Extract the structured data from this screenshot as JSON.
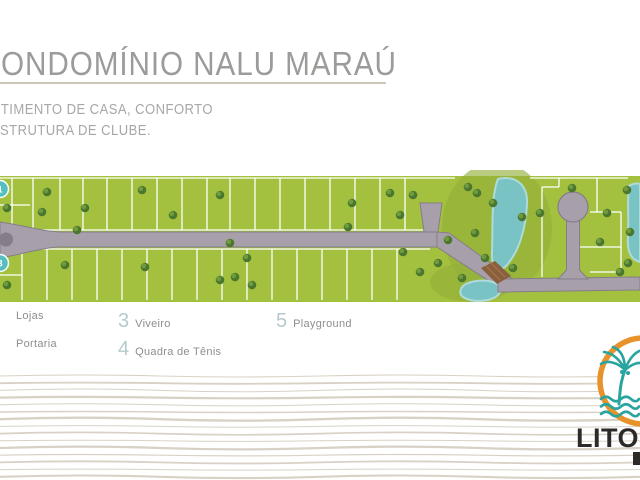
{
  "header": {
    "title": "ONDOMÍNIO NALU MARAÚ",
    "subtitle_line1": "NTIMENTO DE CASA, CONFORTO",
    "subtitle_line2": "STRUTURA DE CLUBE.",
    "title_color": "#9b9b99",
    "subtitle_color": "#a7a7a5",
    "rule_color": "#cdc6ba"
  },
  "legend": {
    "number_color": "#b4cacc",
    "label_color": "#8e8e8c",
    "items": [
      {
        "number": "",
        "label": "Lojas"
      },
      {
        "number": "",
        "label": "Portaria"
      },
      {
        "number": "3",
        "label": "Viveiro"
      },
      {
        "number": "4",
        "label": "Quadra de Tênis"
      },
      {
        "number": "5",
        "label": "Playground"
      }
    ]
  },
  "map": {
    "colors": {
      "grass": "#a3c13e",
      "grass_dark": "#94b13a",
      "road": "#a7a0ab",
      "road_edge": "#857d8a",
      "lot_line": "#ffffff",
      "water": "#7ac3c5",
      "water_edge": "#aedbd9",
      "tree_dark": "#4a762f",
      "tree_light": "#74a03e",
      "bridge": "#8a5f3e",
      "bridge_light": "#a5764d",
      "marker": "#54bec0",
      "marker_text": "#ffffff"
    },
    "grass": {
      "y": 6,
      "h": 126
    },
    "dark_patches": [
      [
        497,
        58,
        55,
        66
      ],
      [
        472,
        112,
        42,
        20
      ]
    ],
    "lot_lines": {
      "upper_xs": [
        12,
        33,
        60,
        83,
        107,
        132,
        157,
        182,
        207,
        230,
        255,
        280,
        305,
        330,
        355,
        380,
        405
      ],
      "upper_y": [
        8,
        60
      ],
      "lower_xs": [
        22,
        47,
        72,
        97,
        122,
        147,
        172,
        197,
        222,
        247,
        272,
        297,
        322,
        347,
        372,
        397
      ],
      "lower_y": [
        79,
        130
      ],
      "segments": [
        [
          0,
          8,
          455,
          8
        ],
        [
          530,
          8,
          628,
          8
        ],
        [
          0,
          60,
          437,
          60
        ],
        [
          0,
          79,
          430,
          79
        ],
        [
          0,
          35,
          30,
          35
        ],
        [
          0,
          105,
          22,
          105
        ],
        [
          542,
          17,
          542,
          107
        ],
        [
          542,
          17,
          559,
          17
        ],
        [
          559,
          8,
          559,
          17
        ],
        [
          597,
          8,
          597,
          42
        ],
        [
          590,
          42,
          621,
          42
        ],
        [
          621,
          42,
          621,
          102
        ],
        [
          580,
          77,
          621,
          77
        ],
        [
          590,
          102,
          621,
          102
        ]
      ]
    },
    "roads_a": [
      "M0,52 C28,56 44,62 62,62 L437,62 L437,77 L62,77 C44,77 28,83 0,88 Z",
      "M420,33 L442,33 L438,62 L424,62 Z",
      "M437,62 L449,63 L511,108 L498,117 L437,77 Z"
    ],
    "roads_b": [
      "M498,109 L640,107 L640,120 L498,122 Z",
      "M566.5,38 L579.5,38 L579.5,100 L588,109 L558,109 L566.5,100 Z"
    ],
    "culdesac": {
      "cx": 573,
      "cy": 37,
      "r": 15
    },
    "roundabout": {
      "cx": 6,
      "cy": 69.5,
      "r": 7
    },
    "water": [
      "M498,9 C515,5 528,14 527,34 C526,58 519,82 506,96 C499,103 491,98 492,82 C493,56 491,26 498,9 Z",
      "M461,119 C464,110 492,107 499,116 C504,124 494,131 477,131 C465,130 458,126 461,119 Z",
      "M629,16 C635,12 640,14 640,14 L640,92 C632,90 627,83 628,68 C629,48 627,32 629,16 Z"
    ],
    "bridge": {
      "d": "M481,98 L495,91 L511,106 L497,114 Z",
      "stripes": [
        "M486,96 L500,110",
        "M491,93 L505,107"
      ]
    },
    "trees": [
      [
        47,
        22
      ],
      [
        42,
        42
      ],
      [
        85,
        38
      ],
      [
        142,
        20
      ],
      [
        173,
        45
      ],
      [
        220,
        25
      ],
      [
        77,
        60
      ],
      [
        230,
        73
      ],
      [
        65,
        95
      ],
      [
        145,
        97
      ],
      [
        247,
        88
      ],
      [
        235,
        107
      ],
      [
        220,
        110
      ],
      [
        252,
        115
      ],
      [
        352,
        33
      ],
      [
        390,
        23
      ],
      [
        400,
        45
      ],
      [
        348,
        57
      ],
      [
        413,
        25
      ],
      [
        403,
        82
      ],
      [
        420,
        102
      ],
      [
        438,
        93
      ],
      [
        448,
        70
      ],
      [
        468,
        17
      ],
      [
        477,
        23
      ],
      [
        493,
        33
      ],
      [
        475,
        63
      ],
      [
        462,
        108
      ],
      [
        485,
        88
      ],
      [
        522,
        47
      ],
      [
        513,
        98
      ],
      [
        540,
        43
      ],
      [
        572,
        18
      ],
      [
        600,
        72
      ],
      [
        627,
        20
      ],
      [
        607,
        43
      ],
      [
        630,
        62
      ],
      [
        628,
        93
      ],
      [
        620,
        102
      ],
      [
        7,
        38
      ],
      [
        7,
        115
      ]
    ],
    "markers": [
      {
        "label": "1",
        "x": 0,
        "y": 19
      },
      {
        "label": "3",
        "x": 0,
        "y": 93
      }
    ]
  },
  "waves": {
    "color": "#d8d2c6",
    "count": 15,
    "spacing": 7.2,
    "amps": [
      2,
      1.2,
      2.8,
      1.4,
      2.2,
      1,
      3,
      1.6,
      2.4,
      1.2,
      2.8,
      1.4,
      2.2,
      1,
      2.6
    ],
    "widths": [
      1.1,
      1.8,
      1,
      2.2,
      1,
      1.5,
      2.4,
      1,
      1.7,
      1,
      2.3,
      1.2,
      1.8,
      1,
      2.1
    ]
  },
  "logo": {
    "text": "LITOR",
    "ring_color": "#e8922b",
    "palm_color": "#2aa49f",
    "text_color": "#2d2b29"
  }
}
